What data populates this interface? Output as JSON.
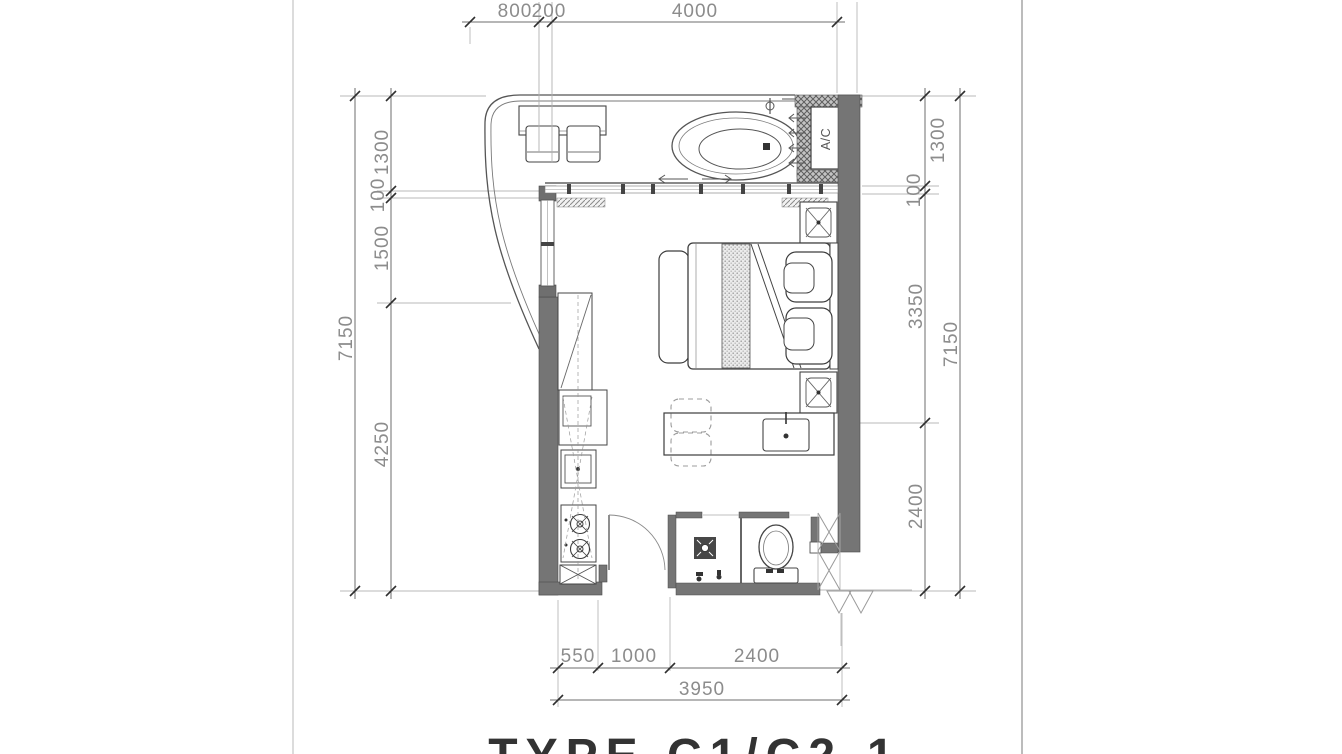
{
  "sheet": {
    "title": "TYPE C1/C2-1"
  },
  "plan": {
    "ac_label": "A/C",
    "rooms": [
      "terrace-jacuzzi",
      "bedroom",
      "kitchenette",
      "bathroom",
      "entry"
    ],
    "colors": {
      "wall_fill": "#757575",
      "line_dark": "#3f3f3f",
      "line_light": "#b8b8b8",
      "dim_text": "#8c8c8c",
      "title_text": "#333333"
    }
  },
  "dimensions": {
    "top": [
      "800",
      "200",
      "4000"
    ],
    "left": {
      "total": "7150",
      "parts": [
        "1300",
        "100",
        "1500",
        "4250"
      ]
    },
    "right": {
      "total": "7150",
      "parts": [
        "1300",
        "100",
        "3350",
        "2400"
      ]
    },
    "bottom": {
      "total": "3950",
      "parts": [
        "550",
        "1000",
        "2400"
      ]
    }
  }
}
